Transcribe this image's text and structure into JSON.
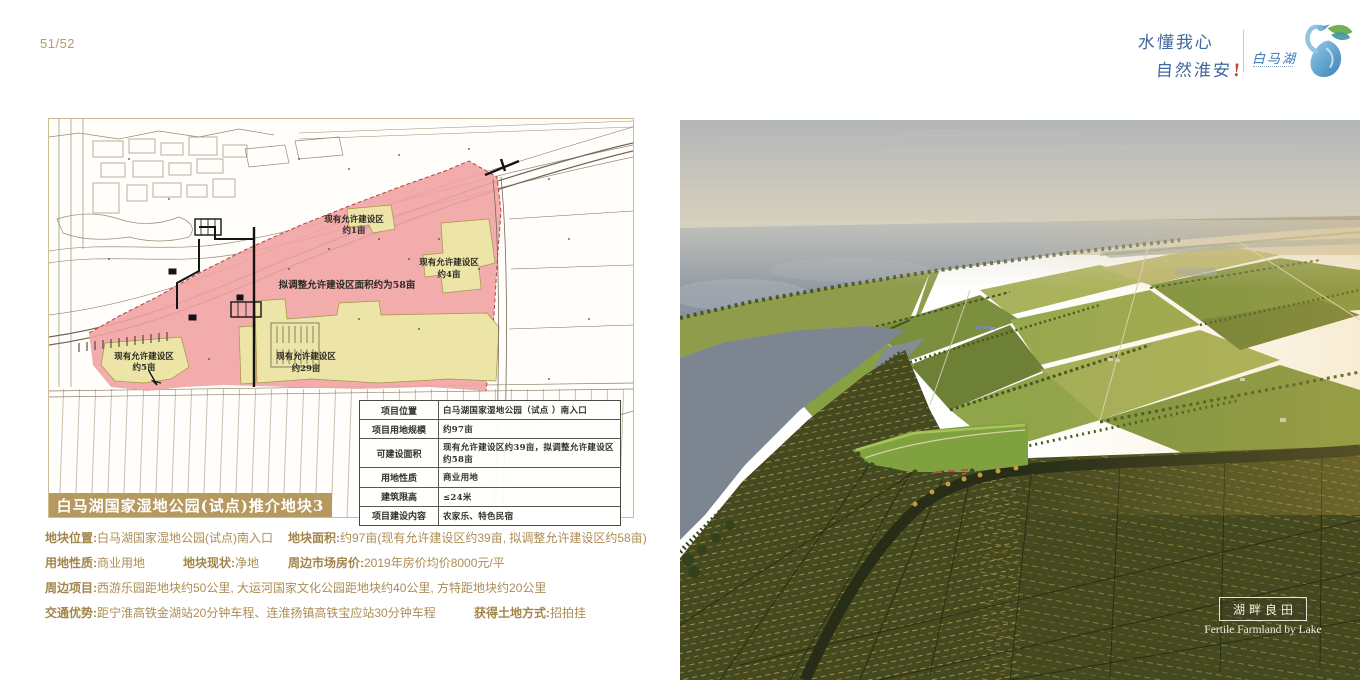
{
  "page": {
    "number": "51/52"
  },
  "brand": {
    "slogan_line1": "水懂我心",
    "slogan_line2": "自然淮安",
    "slogan_mark": "!",
    "logo_name": "白马湖"
  },
  "map": {
    "banner": "白马湖国家湿地公园(试点)推介地块3",
    "zones": {
      "z1a": "现有允许建设区",
      "z1b": "约1亩",
      "z4a": "现有允许建设区",
      "z4b": "约4亩",
      "z5a": "现有允许建设区",
      "z5b": "约5亩",
      "z29a": "现有允许建设区",
      "z29b": "约29亩",
      "z58": "拟调整允许建设区面积约为58亩"
    },
    "table": {
      "rows": [
        {
          "label": "项目位置",
          "value": "白马湖国家湿地公园（试点 ）南入口"
        },
        {
          "label": "项目用地规模",
          "value": "约97亩"
        },
        {
          "label": "可建设面积",
          "value": "现有允许建设区约39亩，拟调整允许建设区约58亩"
        },
        {
          "label": "用地性质",
          "value": "商业用地"
        },
        {
          "label": "建筑限高",
          "value": "≤24米"
        },
        {
          "label": "项目建设内容",
          "value": "农家乐、特色民宿"
        }
      ]
    }
  },
  "details": {
    "line1": {
      "seg1_label": "地块位置:",
      "seg1_value": "白马湖国家湿地公园(试点)南入口",
      "seg2_label": "地块面积:",
      "seg2_value": "约97亩(现有允许建设区约39亩, 拟调整允许建设区约58亩)"
    },
    "line2": {
      "seg1_label": "用地性质:",
      "seg1_value": "商业用地",
      "seg2_label": "地块现状:",
      "seg2_value": "净地",
      "seg3_label": "周边市场房价:",
      "seg3_value": "2019年房价均价8000元/平"
    },
    "line3": {
      "seg1_label": "周边项目:",
      "seg1_value": "西游乐园距地块约50公里, 大运河国家文化公园距地块约40公里, 方特距地块约20公里"
    },
    "line4": {
      "seg1_label": "交通优势:",
      "seg1_value": "距宁淮高铁金湖站20分钟车程、连淮扬镇高铁宝应站30分钟车程",
      "seg2_label": "获得土地方式:",
      "seg2_value": "招拍挂"
    }
  },
  "photo": {
    "caption_cn": "湖畔良田",
    "caption_en": "Fertile Farmland by Lake"
  },
  "colors": {
    "accent_gold": "#b5995f",
    "text_gold": "#ac8d55",
    "slogan_blue": "#41699f",
    "zone_pink": "#f0a3a2",
    "zone_yellow": "#ece5a7",
    "photo_water": "#828c98",
    "photo_field_green": "#8e9c4b"
  }
}
